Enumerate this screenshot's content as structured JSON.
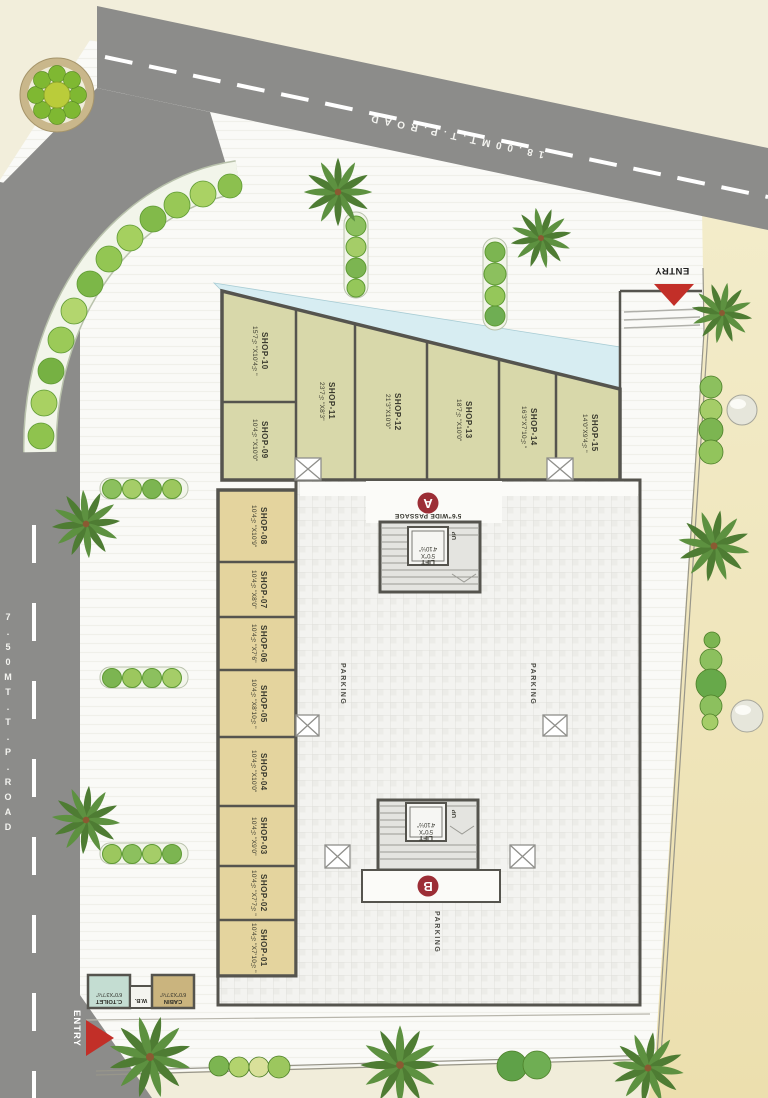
{
  "roads": {
    "top": {
      "label": "18.00MT.T.P.ROAD"
    },
    "left": {
      "label": "7.50MT.T.P.ROAD"
    }
  },
  "entries": {
    "top": "ENTRY",
    "bottom": "ENTRY"
  },
  "parking": {
    "label": "PARKING"
  },
  "blocks": {
    "a": {
      "letter": "A",
      "passage": "5'6\"WIDE PASSAGE",
      "up": "UP",
      "lift": {
        "l1": "LIFT",
        "l2": "5'0\"X",
        "l3": "4'10½\""
      }
    },
    "b": {
      "letter": "B",
      "up": "UP",
      "lift": {
        "l1": "LIFT",
        "l2": "5'0\"X",
        "l3": "4'10½\""
      }
    }
  },
  "rooms": {
    "toilet": {
      "name": "C.TOILET",
      "dims": "6'0\"X3'7½\""
    },
    "wb": {
      "name": "W.B."
    },
    "cabin": {
      "name": "CABIN",
      "dims": "6'0\"X3'7½\""
    }
  },
  "shops_top": [
    {
      "name": "SHOP-09",
      "dims": "10'4½\"X10'0\""
    },
    {
      "name": "SHOP-10",
      "dims": "15'7½\"X10'4½\""
    },
    {
      "name": "SHOP-11",
      "dims": "23'7½\"X8'3\""
    },
    {
      "name": "SHOP-12",
      "dims": "21'3\"X10'0\""
    },
    {
      "name": "SHOP-13",
      "dims": "18'7½\"X10'0\""
    },
    {
      "name": "SHOP-14",
      "dims": "16'3\"X7'10½\""
    },
    {
      "name": "SHOP-15",
      "dims": "14'0\"X9'4½\""
    }
  ],
  "shops_left": [
    {
      "name": "SHOP-08",
      "dims": "10'4½\"X10'9\""
    },
    {
      "name": "SHOP-07",
      "dims": "10'4½\"X8'0\""
    },
    {
      "name": "SHOP-06",
      "dims": "10'4½\"X7'6\""
    },
    {
      "name": "SHOP-05",
      "dims": "10'4½\"X8'10½\""
    },
    {
      "name": "SHOP-04",
      "dims": "10'4½\"X10'0\""
    },
    {
      "name": "SHOP-03",
      "dims": "10'4½\"X9'0\""
    },
    {
      "name": "SHOP-02",
      "dims": "10'4½\"X7'7½\""
    },
    {
      "name": "SHOP-01",
      "dims": "10'4½\"X7'10½\""
    }
  ],
  "colors": {
    "road_gray": "#8c8c8a",
    "shop_tan": "#e4d49e",
    "shop_olive": "#d8d8aa",
    "canopy_cyan": "#d7edf2",
    "block_circle_red": "#9c2e36",
    "entry_red": "#c22f28",
    "toilet_teal": "#c4ddd2",
    "cabin_tan": "#cab47e"
  }
}
